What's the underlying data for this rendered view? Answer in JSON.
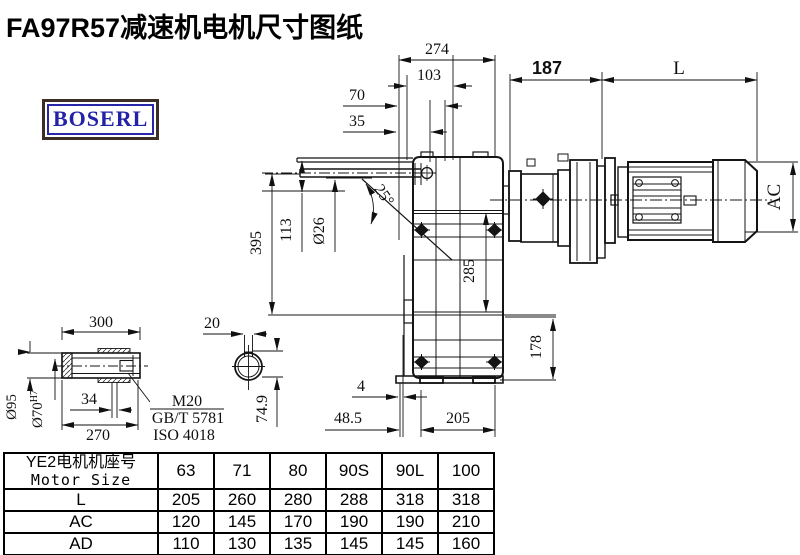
{
  "title": "FA97R57减速机电机尺寸图纸",
  "logo": "BOSERL",
  "drawing": {
    "dims": {
      "w274": "274",
      "w103": "103",
      "w70": "70",
      "w35": "35",
      "w187": "187",
      "motor_length": "L",
      "motor_dia": "AC",
      "h395": "395",
      "h113": "113",
      "shaft_dia": "Ø26",
      "angle": "25°",
      "h285": "285",
      "h178": "178",
      "b4": "4",
      "b48_5": "48.5",
      "b205": "205",
      "s300": "300",
      "s270": "270",
      "s34": "34",
      "s95": "Ø95",
      "s70": "Ø70",
      "s70_tol": "H7",
      "s20": "20",
      "s74_9": "74.9"
    },
    "notes": {
      "thread": "M20",
      "standard_gb": "GB/T 5781",
      "standard_iso": "ISO 4018"
    }
  },
  "table": {
    "corner": {
      "line1": "YE2电机机座号",
      "line2": "Motor Size"
    },
    "columns": [
      "63",
      "71",
      "80",
      "90S",
      "90L",
      "100"
    ],
    "rows": [
      {
        "label": "L",
        "values": [
          "205",
          "260",
          "280",
          "288",
          "318",
          "318"
        ]
      },
      {
        "label": "AC",
        "values": [
          "120",
          "145",
          "170",
          "190",
          "190",
          "210"
        ]
      },
      {
        "label": "AD",
        "values": [
          "110",
          "130",
          "135",
          "145",
          "145",
          "160"
        ]
      }
    ]
  }
}
